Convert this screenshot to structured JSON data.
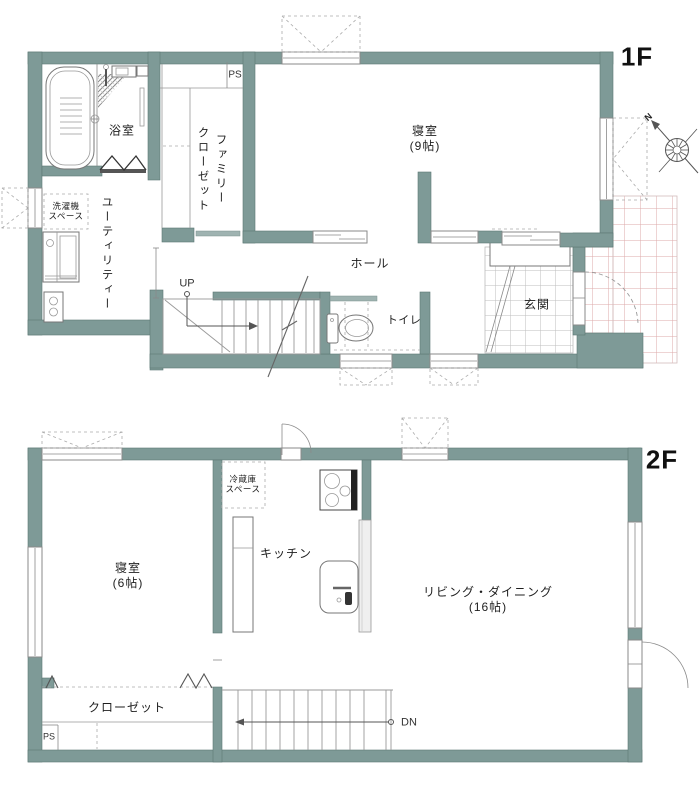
{
  "colors": {
    "wall": "#7e9a97",
    "tile_pink": "#dcaaaa",
    "tile_gray": "#bdbdbd"
  },
  "floor1": {
    "label": "1F",
    "bathroom": "浴室",
    "family_closet_line1": "ファミリー",
    "family_closet_line2": "クローゼット",
    "ps": "PS",
    "bedroom_name": "寝室",
    "bedroom_size": "(9帖)",
    "washer_line1": "洗濯機",
    "washer_line2": "スペース",
    "utility": "ユーティリティー",
    "up": "UP",
    "hall": "ホール",
    "toilet": "トイレ",
    "entrance": "玄関",
    "compass_n": "N"
  },
  "floor2": {
    "label": "2F",
    "fridge_line1": "冷蔵庫",
    "fridge_line2": "スペース",
    "kitchen": "キッチン",
    "bedroom_name": "寝室",
    "bedroom_size": "(6帖)",
    "living_name": "リビング・ダイニング",
    "living_size": "(16帖)",
    "closet": "クローゼット",
    "ps": "PS",
    "dn": "DN"
  }
}
